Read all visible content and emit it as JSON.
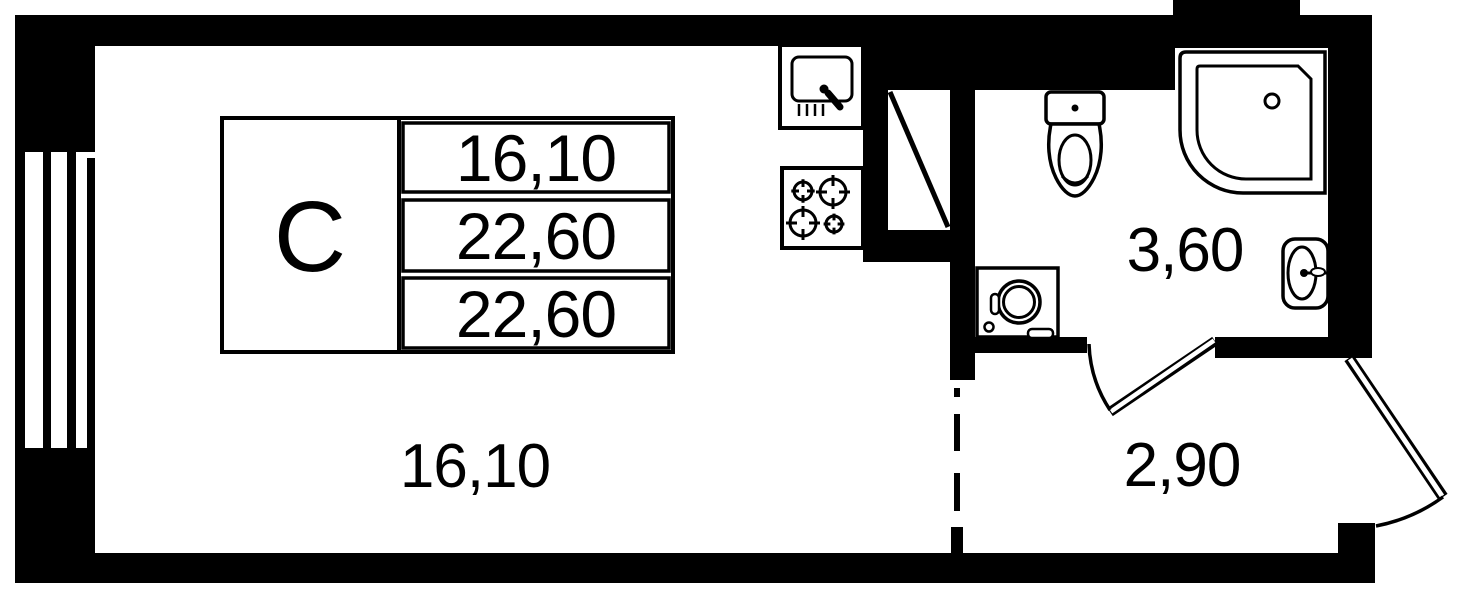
{
  "legend": {
    "unit_type": "С",
    "rows": [
      {
        "value": "16,10"
      },
      {
        "value": "22,60"
      },
      {
        "value": "22,60"
      }
    ]
  },
  "rooms": {
    "living_area": "16,10",
    "bathroom_area": "3,60",
    "hallway_area": "2,90"
  },
  "colors": {
    "wall": "#000000",
    "background": "#ffffff"
  }
}
